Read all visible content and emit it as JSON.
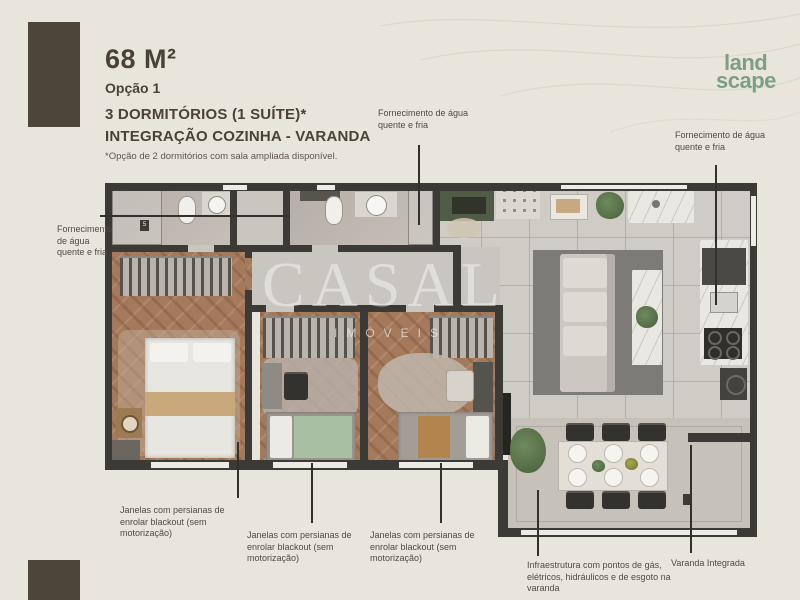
{
  "header": {
    "area": "68 M²",
    "option": "Opção 1",
    "title_line1": "3 DORMITÓRIOS (1 SUÍTE)*",
    "title_line2": "INTEGRAÇÃO COZINHA - VARANDA",
    "footnote": "*Opção de 2 dormitórios com sala ampliada disponível."
  },
  "logo": {
    "line1": "land",
    "line2": "scape"
  },
  "watermark": {
    "name": "CASAL",
    "subtitle": "IMÓVEIS"
  },
  "annotations": [
    {
      "id": "water-supply-left",
      "text": "Fornecimento de água quente e fria"
    },
    {
      "id": "water-supply-top",
      "text": "Fornecimento de água quente e fria"
    },
    {
      "id": "water-supply-right",
      "text": "Fornecimento de água quente e fria"
    },
    {
      "id": "window-blackout-1",
      "text": "Janelas com persianas de enrolar blackout (sem motorização)"
    },
    {
      "id": "window-blackout-2",
      "text": "Janelas com persianas de enrolar blackout (sem motorização)"
    },
    {
      "id": "window-blackout-3",
      "text": "Janelas com persianas de enrolar blackout (sem motorização)"
    },
    {
      "id": "varanda-infra",
      "text": "Infraestrutura com pontos de gás, elétricos, hidráulicos e de esgoto na varanda"
    },
    {
      "id": "varanda-integrada",
      "text": "Varanda Integrada"
    }
  ],
  "plan": {
    "wall_tag": "5"
  },
  "colors": {
    "background": "#e8e5dd",
    "accent_brown_block": "#4d443a",
    "logo_green": "#7f9e86",
    "wall": "#3b3a36",
    "wood_floor": "#a57a5c",
    "green_cabinet": "#515c46",
    "bed_green": "#a8bfa4",
    "plant_green": "#5d7a4e",
    "text_dark": "#4a4238"
  }
}
